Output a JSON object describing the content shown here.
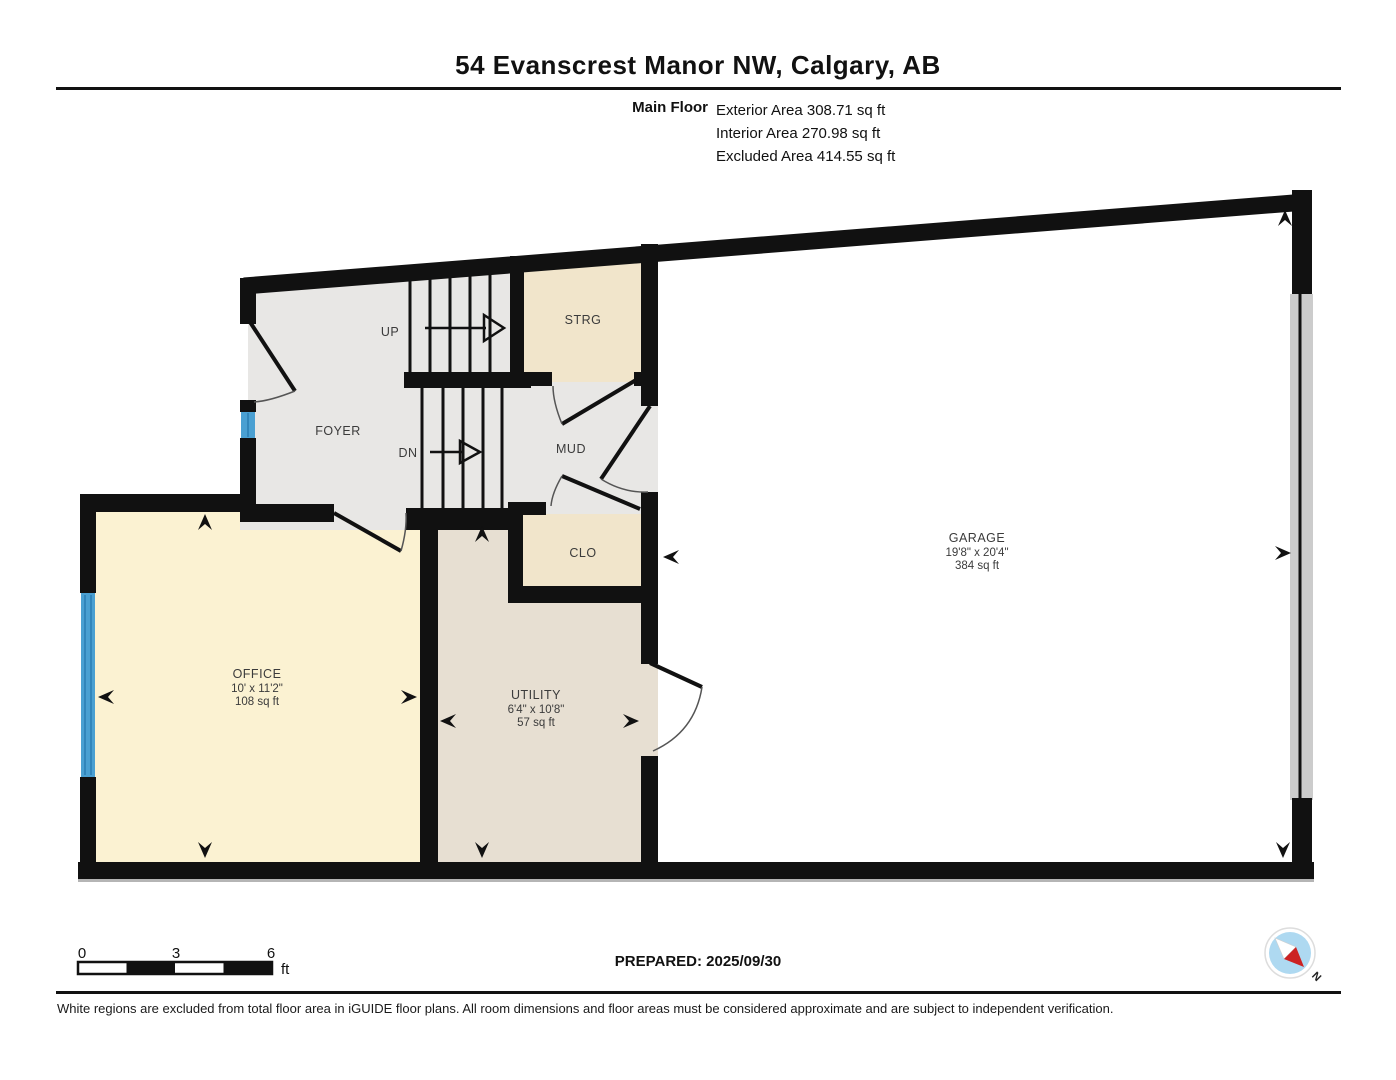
{
  "header": {
    "title": "54 Evanscrest Manor NW, Calgary, AB",
    "floor_label": "Main Floor",
    "areas": [
      "Exterior Area 308.71 sq ft",
      "Interior Area 270.98 sq ft",
      "Excluded Area 414.55 sq ft"
    ]
  },
  "rooms": {
    "foyer": {
      "label": "FOYER"
    },
    "stairs_up": {
      "label": "UP"
    },
    "stairs_dn": {
      "label": "DN"
    },
    "storage": {
      "label": "STRG"
    },
    "mud": {
      "label": "MUD"
    },
    "closet": {
      "label": "CLO"
    },
    "office": {
      "label": "OFFICE",
      "dims": "10' x 11'2\"",
      "area": "108 sq ft"
    },
    "utility": {
      "label": "UTILITY",
      "dims": "6'4\" x 10'8\"",
      "area": "57 sq ft"
    },
    "garage": {
      "label": "GARAGE",
      "dims": "19'8\" x 20'4\"",
      "area": "384 sq ft"
    }
  },
  "scale_bar": {
    "ticks": [
      "0",
      "3",
      "6"
    ],
    "unit": "ft"
  },
  "prepared": {
    "text": "PREPARED: 2025/09/30"
  },
  "compass": {
    "label": "N"
  },
  "footer": {
    "disclaimer": "White regions are excluded from total floor area in iGUIDE floor plans. All room dimensions and floor areas must be considered approximate and are subject to independent verification."
  },
  "colors": {
    "wall": "#111111",
    "floor_gray": "#e8e7e5",
    "floor_tan": "#f1e5cb",
    "floor_cream": "#fbf2d2",
    "floor_beige": "#e7dfd2",
    "window_blue": "#4aa0d2",
    "garage_door_gray": "#cccccc",
    "compass_blue": "#aed9f1",
    "compass_red": "#cc2222"
  }
}
